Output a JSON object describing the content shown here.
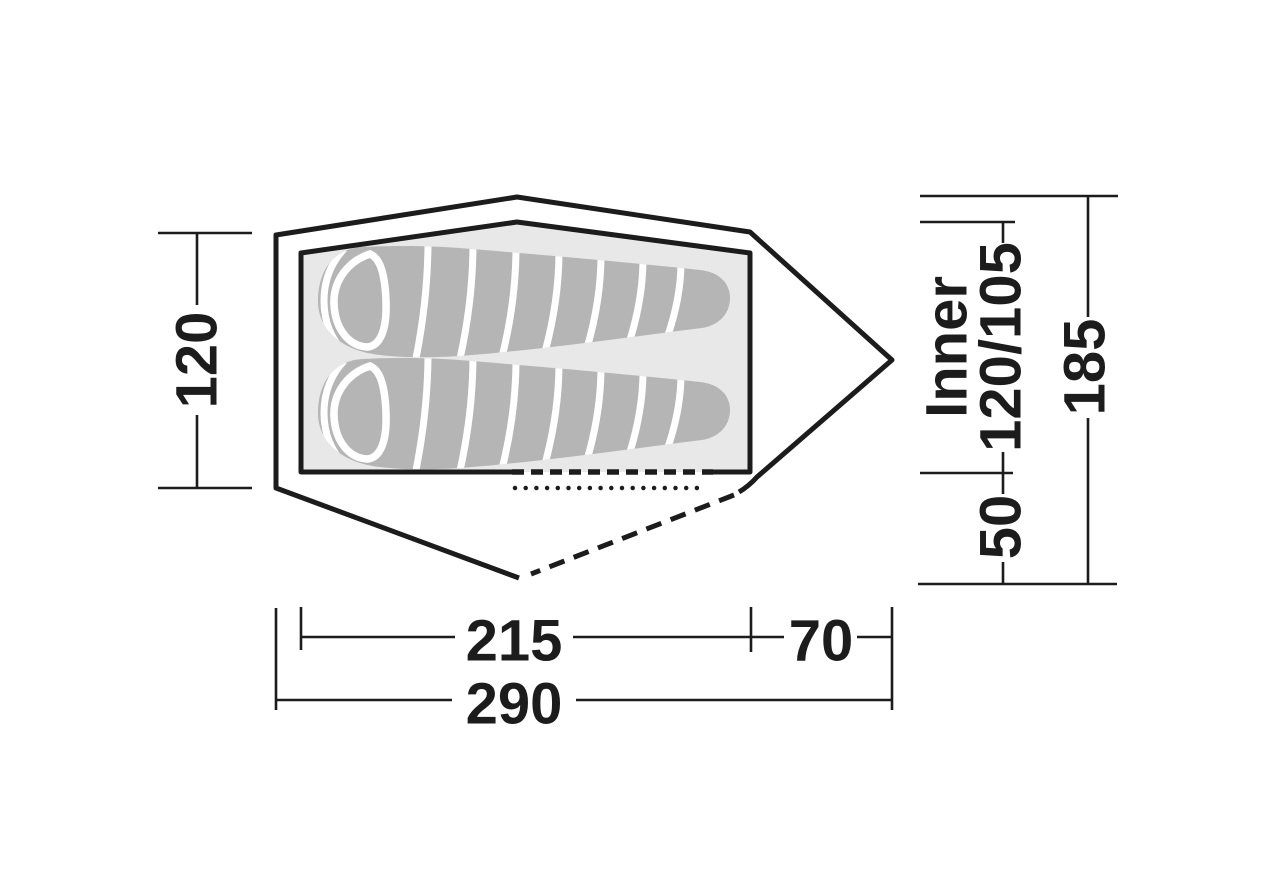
{
  "diagram": {
    "dims": {
      "left_width": "120",
      "inner_length": "215",
      "porch_length": "70",
      "total_length": "290",
      "total_height": "185",
      "porch_depth": "50",
      "inner_label": "Inner",
      "inner_width": "120/105"
    },
    "colors": {
      "line": "#1c1c1c",
      "floor": "#e8e8e8",
      "sleeping_bag": "#b5b5b5",
      "background": "#ffffff"
    }
  }
}
